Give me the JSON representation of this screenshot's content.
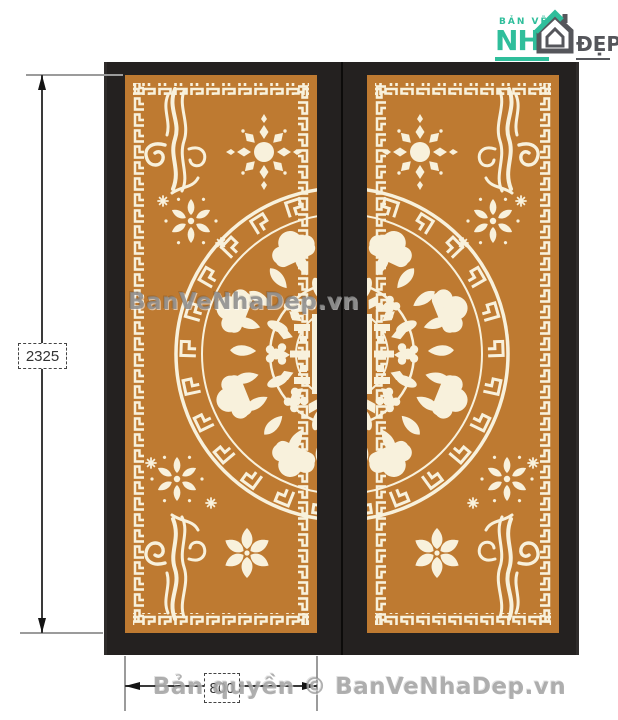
{
  "logo": {
    "top_text": "BẢN VẼ",
    "main_green": "NH",
    "main_gray": "ĐẸP"
  },
  "annotations": {
    "height_dim": "2325",
    "width_dim": "800"
  },
  "watermarks": {
    "center": "BanVeNhaDep.vn",
    "bottom": "Bản quyền © BanVeNhaDep.vn"
  },
  "drawing": {
    "subject": "double-door CNC decorative panel",
    "left_door": "left-door-leaf",
    "right_door": "right-door-leaf",
    "motifs": [
      "greek-key-border",
      "wind-swirl",
      "sun-medallion",
      "snowflake-floral",
      "half-circle-mandala",
      "six-petal-flower",
      "sparkles"
    ]
  },
  "colors": {
    "panel_orange": "#BE7A31",
    "pattern_cream": "#F8F1DC",
    "frame_dark": "#242120",
    "logo_green": "#2FBE9B",
    "logo_gray": "#55565B",
    "dim_line": "#3A3A3A",
    "ext_line": "#9B9B9B",
    "watermark_gray": "#9B9B9B"
  }
}
